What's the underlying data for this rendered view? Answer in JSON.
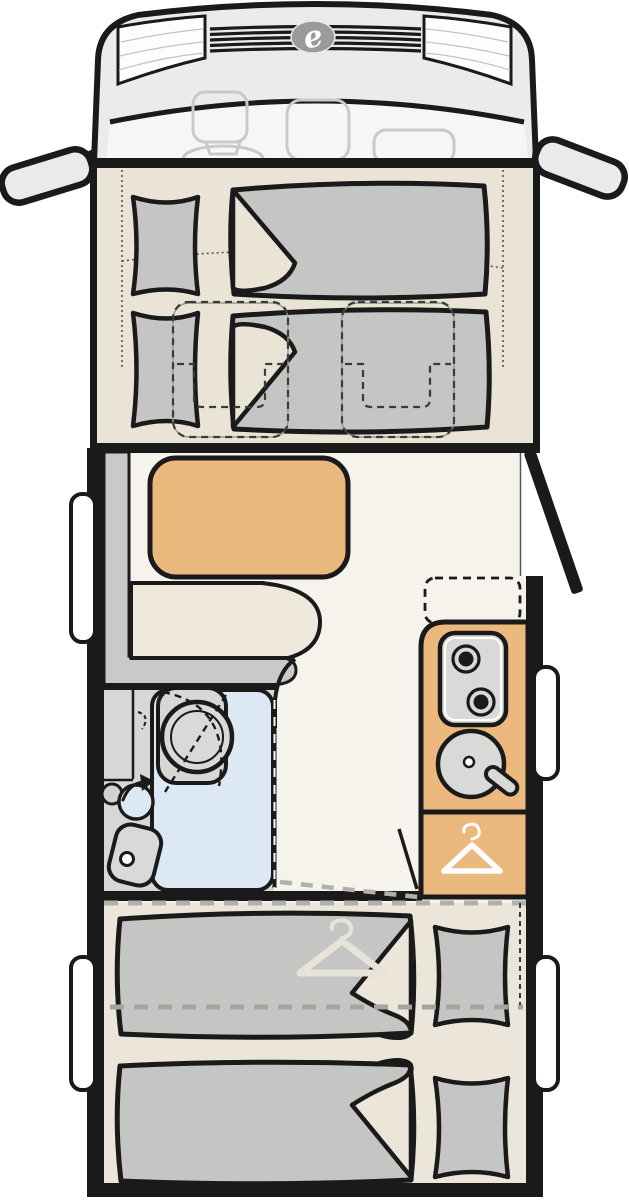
{
  "diagram": {
    "type": "motorhome floor plan, top view",
    "logo_letter": "e"
  },
  "features": {
    "front_drop_down_beds": 2,
    "travel_seats_under_front_bed": 2,
    "rear_single_beds": 2,
    "pillows": 4,
    "hob_burners": 2,
    "sinks": 1,
    "washbasin": 1,
    "toilet": 1,
    "shower": 1,
    "wardrobe_hanger_icons": 2,
    "side_windows": 4,
    "exterior_mirrors": 2,
    "entry_door_open": true,
    "optional_unit_dashed": true
  },
  "colors": {
    "ink": "#1a1a1a",
    "cab_body": "#ebebe9",
    "cab_dash_area": "#f6f6f4",
    "cab_glass": "#fdfdfc",
    "faint_seat": "#c9c9c6",
    "logo_gray": "#9a9a9a",
    "mirror_glass": "#eaeaea",
    "front_floor": "#eae4d7",
    "lounge_floor": "#f6f3ec",
    "rear_floor": "#ebe6d9",
    "mattress": "#c5c5c3",
    "bench_seat": "#efe9dc",
    "backrest_gray": "#c9c9c7",
    "table_top": "#ebb97d",
    "kitchen_top": "#ebb97d",
    "appliance_gray": "#d9d9d7",
    "shower_blue": "#dce8f4",
    "bath_gray": "#d7d7d5",
    "window_white": "#ffffff",
    "hanger_faint": "#e7e3d8",
    "dash_gray": "#b1b1ac",
    "wall_black": "#1a1a1a"
  }
}
